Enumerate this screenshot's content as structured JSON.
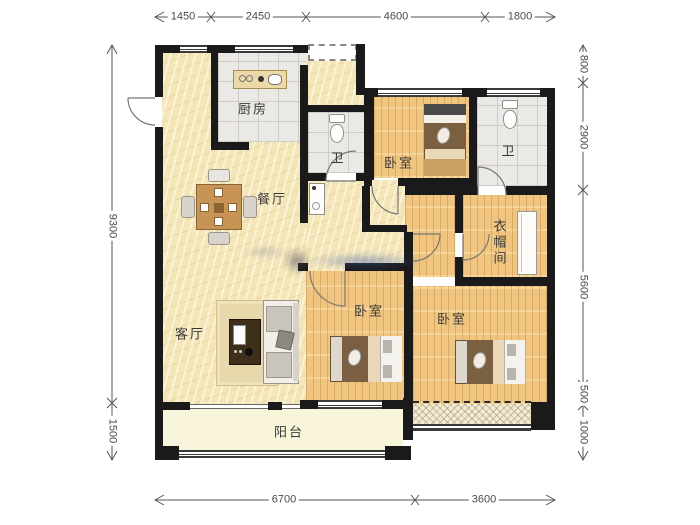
{
  "title": "residential-floor-plan",
  "dims": {
    "top": [
      "1450",
      "2450",
      "4600",
      "1800"
    ],
    "bottom": [
      "6700",
      "3600"
    ],
    "left": [
      "9300",
      "1500"
    ],
    "right": [
      "800",
      "2900",
      "5600",
      "500",
      "1000"
    ]
  },
  "rooms": {
    "kitchen": "厨房",
    "bath_top": "卫",
    "bath_right": "卫",
    "bedroom_top": "卧室",
    "bedroom_mid": "卧室",
    "bedroom_right": "卧室",
    "dining": "餐厅",
    "living": "客厅",
    "cloakroom": "衣帽间",
    "balcony": "阳台"
  },
  "colors": {
    "wall": "#1a1a1a",
    "marble_floor": "#f4e6b6",
    "wood_floor": "#efc57f",
    "tile_floor": "#eae9e5",
    "balcony_floor": "#f9f5da",
    "dimension_text": "#4a4a4a",
    "label_text": "#3a3a3a"
  }
}
